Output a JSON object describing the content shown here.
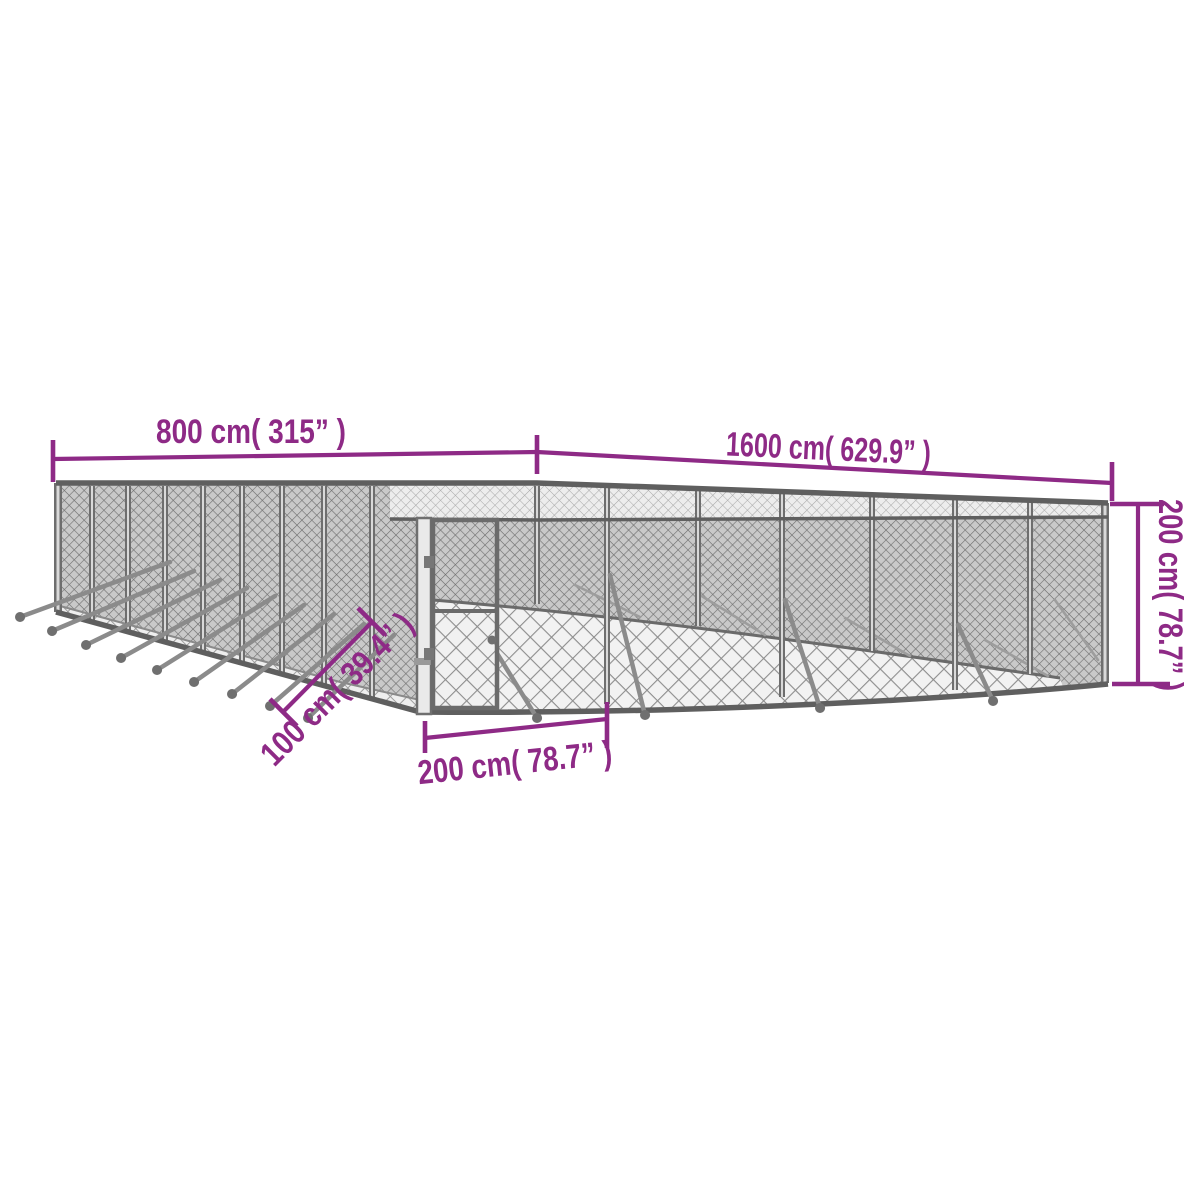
{
  "diagram": {
    "colors": {
      "accent": "#8e2a86",
      "fence_dark": "#6e6e6e",
      "fence_mid": "#8d8d8d",
      "background": "#ffffff"
    },
    "dimensions": {
      "side_width": {
        "label": "800 cm( 315” )"
      },
      "side_length": {
        "label": "1600 cm( 629.9” )"
      },
      "height": {
        "label": "200 cm( 78.7” )"
      },
      "door_offset": {
        "label": "100 cm( 39.4” )"
      },
      "door_width": {
        "label": "200 cm( 78.7” )"
      }
    }
  }
}
